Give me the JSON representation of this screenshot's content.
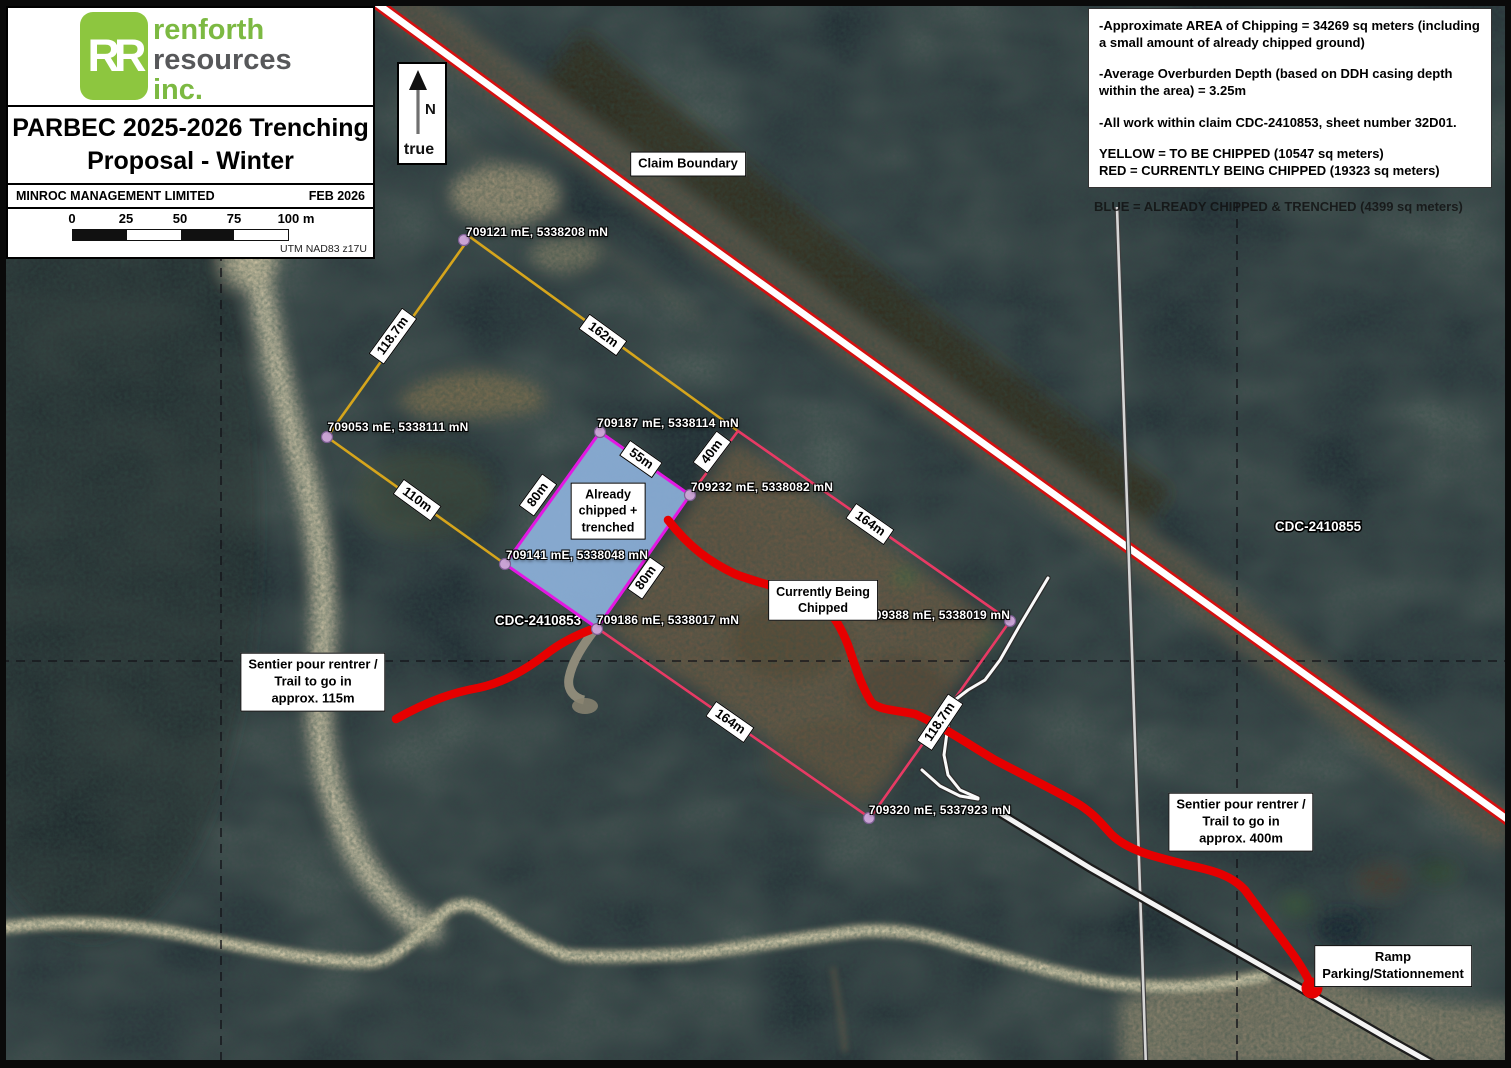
{
  "title_block": {
    "logo": {
      "tile": "RR",
      "name_line1": "renforth",
      "name_line2": "resources",
      "name_line3": "inc."
    },
    "title_line1": "PARBEC 2025-2026 Trenching",
    "title_line2": "Proposal - Winter",
    "company": "MINROC MANAGEMENT LIMITED",
    "date": "FEB 2026",
    "scale": {
      "t0": "0",
      "t25": "25",
      "t50": "50",
      "t75": "75",
      "t100": "100 m",
      "datum": "UTM NAD83 z17U"
    }
  },
  "north_arrow": {
    "n": "N",
    "label": "true"
  },
  "info_box": {
    "p1": "-Approximate AREA of Chipping = 34269 sq meters (including a small amount of already chipped ground)",
    "p2": "-Average Overburden Depth (based on DDH casing depth within the area) = 3.25m",
    "p3": "-All work within claim CDC-2410853, sheet number 32D01.",
    "p4": "YELLOW = TO BE CHIPPED (10547 sq meters)",
    "p5": "RED = CURRENTLY BEING CHIPPED (19323 sq meters)",
    "overflow": "BLUE = ALREADY CHIPPED & TRENCHED (4399 sq meters)"
  },
  "map": {
    "claim_boundary_label": "Claim Boundary",
    "claim_ids": {
      "c853": "CDC-2410853",
      "c855": "CDC-2410855"
    },
    "vertex_labels": [
      {
        "text": "709121 mE, 5338208 mN"
      },
      {
        "text": "709053 mE, 5338111 mN"
      },
      {
        "text": "709187 mE, 5338114 mN"
      },
      {
        "text": "709232 mE, 5338082 mN"
      },
      {
        "text": "709141 mE, 5338048 mN"
      },
      {
        "text": "709186 mE, 5338017 mN"
      },
      {
        "text": "709388 mE, 5338019 mN"
      },
      {
        "text": "709320 mE, 5337923 mN"
      }
    ],
    "dimension_labels": [
      {
        "text": "118.7m"
      },
      {
        "text": "162m"
      },
      {
        "text": "110m"
      },
      {
        "text": "80m"
      },
      {
        "text": "55m"
      },
      {
        "text": "40m"
      },
      {
        "text": "80m"
      },
      {
        "text": "164m"
      },
      {
        "text": "118.7m"
      },
      {
        "text": "164m"
      }
    ],
    "area_labels": {
      "already": {
        "line1": "Already",
        "line2": "chipped +",
        "line3": "trenched"
      },
      "currently": {
        "line1": "Currently Being",
        "line2": "Chipped"
      },
      "trail_115": {
        "line1": "Sentier pour rentrer /",
        "line2": "Trail to go in",
        "line3": "approx. 115m"
      },
      "trail_400": {
        "line1": "Sentier pour rentrer /",
        "line2": "Trail to go in",
        "line3": "approx. 400m"
      },
      "ramp": {
        "line1": "Ramp",
        "line2": "Parking/Stationnement"
      }
    }
  },
  "colors": {
    "claim_boundary_red": "#d40f0f",
    "to_be_chipped_yellow": "#d6a51c",
    "currently_chipped_pink": "#e83a64",
    "already_chipped_fill": "#8cb0d9",
    "already_chipped_border": "#e318e3",
    "trail_red": "#e60000",
    "vertex_marker": "#c9a3d4",
    "logo_green": "#8dc63f"
  }
}
